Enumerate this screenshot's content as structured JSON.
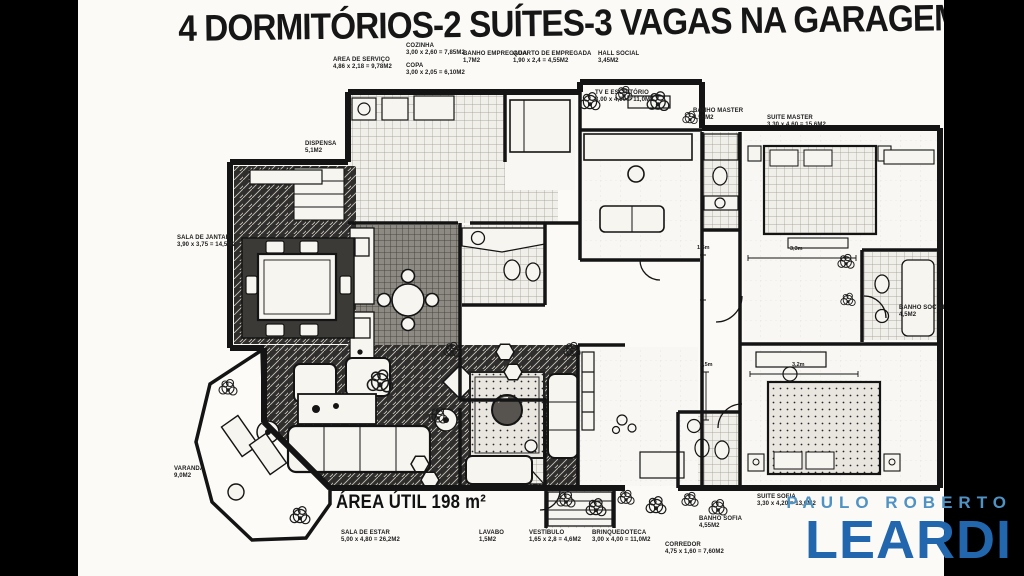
{
  "title": "4 DORMITÓRIOS-2 SUÍTES-3 VAGAS NA GARAGEM",
  "area_util": "ÁREA ÚTIL 198 m²",
  "rooms": {
    "area_servico": {
      "name": "AREA DE SERVIÇO",
      "dims": "4,86 x 2,18 = 9,78M2"
    },
    "cozinha": {
      "name": "COZINHA",
      "dims": "3,00 x 2,60 = 7,85M2"
    },
    "copa": {
      "name": "COPA",
      "dims": "3,00 x 2,05 = 6,10M2"
    },
    "banho_empregada": {
      "name": "BANHO EMPREGADA",
      "dims": "1,7M2"
    },
    "quarto_empregada": {
      "name": "QUARTO DE EMPREGADA",
      "dims": "1,90 x 2,4 = 4,55M2"
    },
    "hall_social": {
      "name": "HALL SOCIAL",
      "dims": "3,45M2"
    },
    "tv_escritorio": {
      "name": "TV E ESCRITÓRIO",
      "dims": "3,00 x 4,00 = 11,0M2"
    },
    "banho_master": {
      "name": "BANHO MASTER",
      "dims": "4,55M2"
    },
    "suite_master": {
      "name": "SUITE MASTER",
      "dims": "3,30 x 4,60 = 15,6M2"
    },
    "dispensa": {
      "name": "DISPENSA",
      "dims": "5,1M2"
    },
    "sala_jantar": {
      "name": "SALA DE JANTAR",
      "dims": "3,90 x 3,75 = 14,5M2"
    },
    "banho_social": {
      "name": "BANHO SOCIAL",
      "dims": "4,5M2"
    },
    "varanda": {
      "name": "VARANDA",
      "dims": "9,0M2"
    },
    "sala_estar": {
      "name": "SALA DE ESTAR",
      "dims": "5,00 x 4,80 = 26,2M2"
    },
    "lavabo": {
      "name": "LAVABO",
      "dims": "1,5M2"
    },
    "vestibulo": {
      "name": "VESTÍBULO",
      "dims": "1,65 x 2,8 = 4,6M2"
    },
    "brinquedoteca": {
      "name": "BRINQUEDOTECA",
      "dims": "3,00 x 4,00 = 11,0M2"
    },
    "banho_sofia": {
      "name": "BANHO SOFIA",
      "dims": "4,55M2"
    },
    "suite_sofia": {
      "name": "SUITE SOFIA",
      "dims": "3,30 x 4,20 = 13,6M2"
    },
    "corredor": {
      "name": "CORREDOR",
      "dims": "4,75 x 1,60 = 7,60M2"
    }
  },
  "dimension_markers": {
    "d1": "1,6m",
    "d2": "3,3m",
    "d3": "1,5m",
    "d4": "3,2m"
  },
  "brand": {
    "line1": "PAULO ROBERTO",
    "line2": "LEARDI",
    "light_accent": "#4f92c4",
    "accent": "#2267ae"
  }
}
